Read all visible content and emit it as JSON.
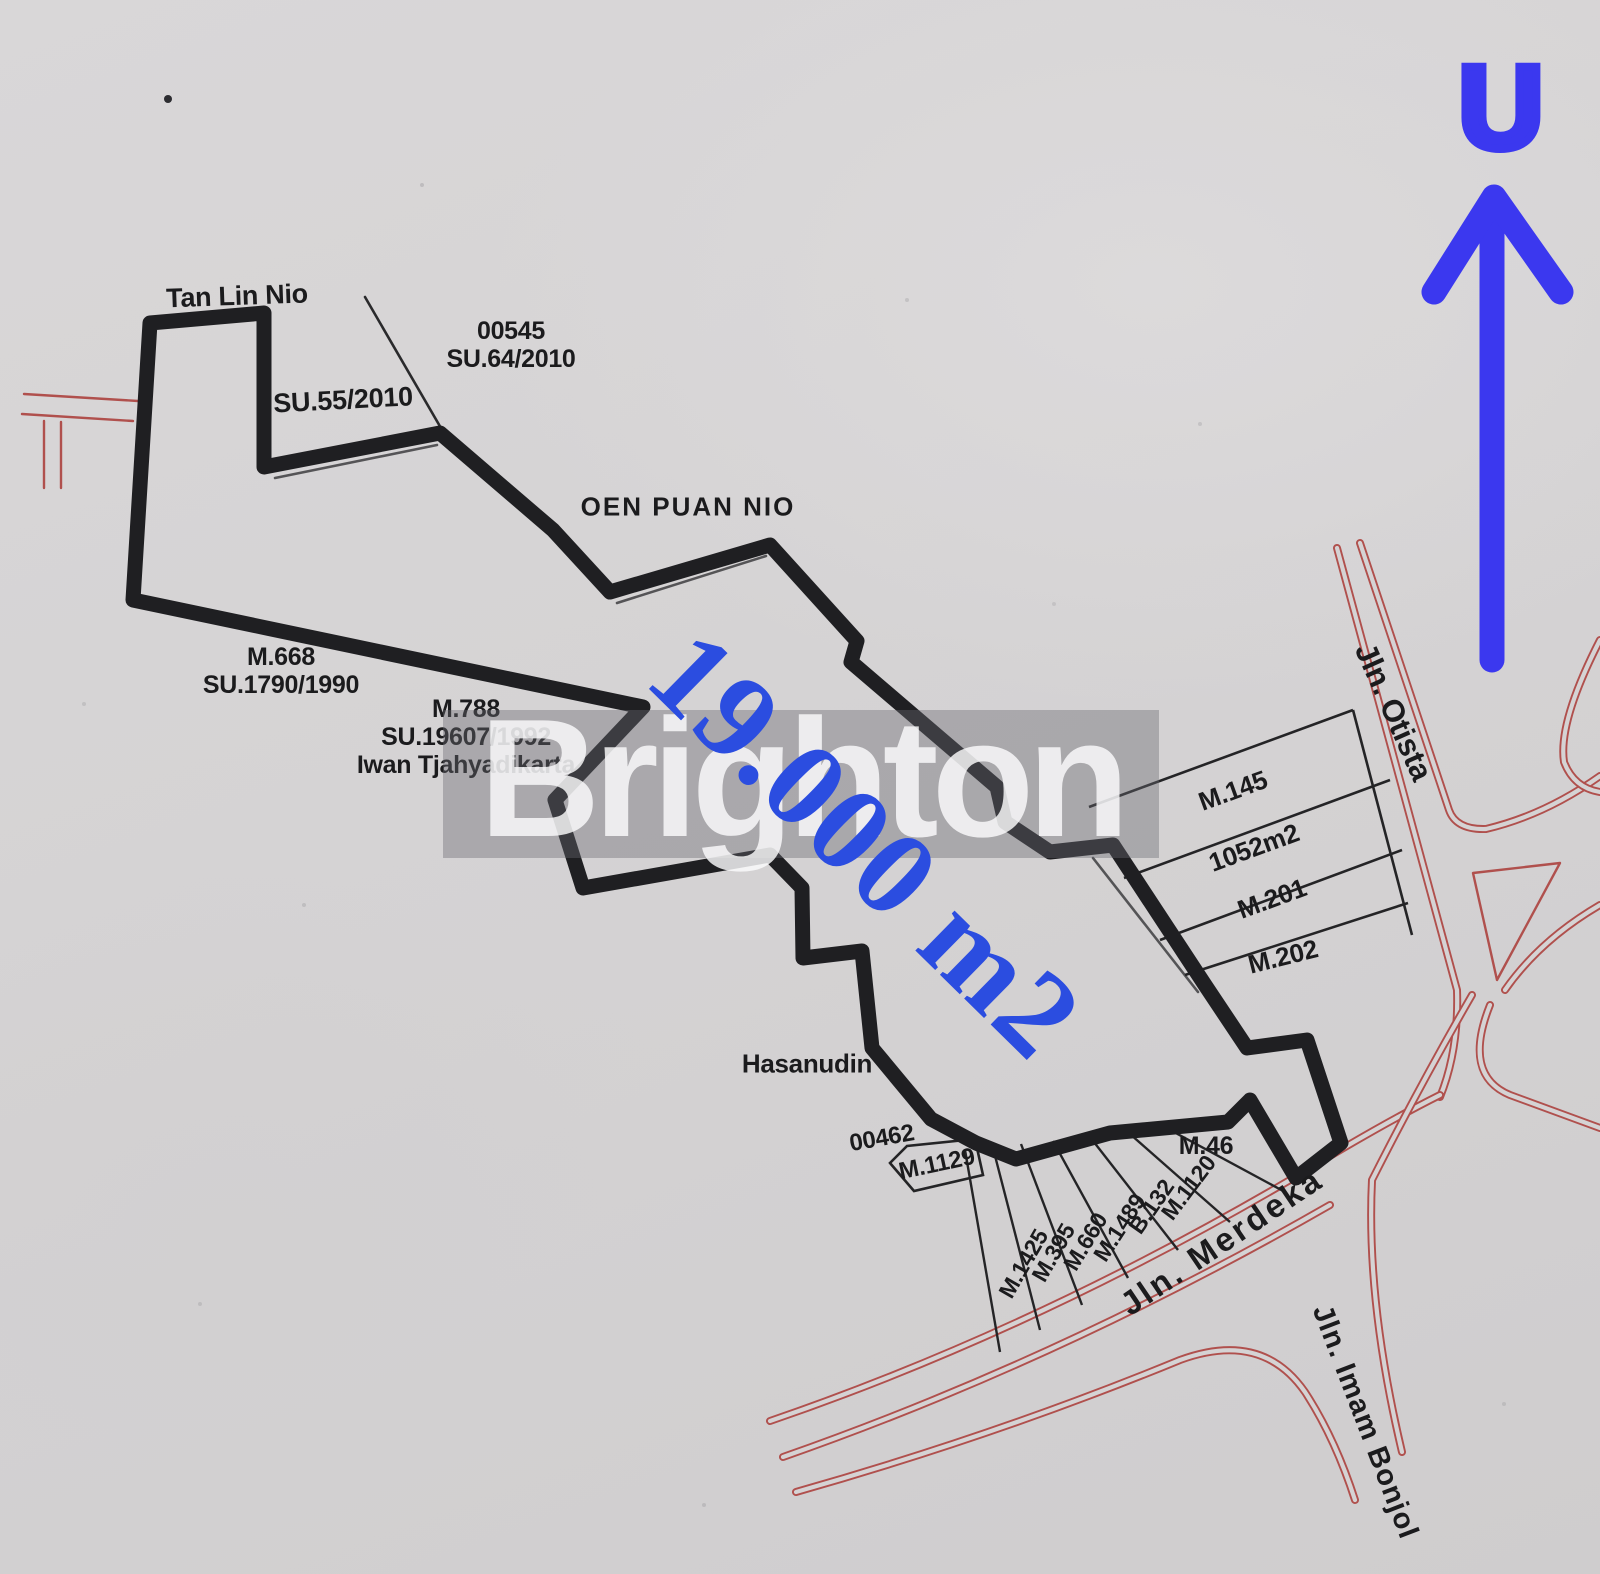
{
  "map_title_note": "cadastral sketch of land parcel",
  "north": {
    "letter": "U"
  },
  "watermark": {
    "text": "Brighton"
  },
  "area": {
    "value": "19.000 m2"
  },
  "colors": {
    "paper": "#d5d3d4",
    "ink": "#1f1f22",
    "road_red": "#b0504d",
    "north_blue": "#3b38ef",
    "area_blue": "#2b4de0"
  },
  "owners": {
    "tan_lin_nio": "Tan Lin Nio",
    "oen_puan_nio": "OEN PUAN NIO",
    "hasanudin": "Hasanudin"
  },
  "certificates": {
    "su55": "SU.55/2010",
    "p00545": {
      "line1": "00545",
      "line2": "SU.64/2010"
    },
    "m668": {
      "line1": "M.668",
      "line2": "SU.1790/1990"
    },
    "m788": {
      "line1": "M.788",
      "line2": "SU.19607/1992",
      "line3": "Iwan Tjahyadikarta"
    },
    "p00462": "00462",
    "m1129": "M.1129",
    "m46": "M.46"
  },
  "strips": [
    {
      "label": "M.145"
    },
    {
      "label": "1052m2"
    },
    {
      "label": "M.201"
    },
    {
      "label": "M.202"
    }
  ],
  "fan_parcels": [
    {
      "label": "M.1425"
    },
    {
      "label": "M.395"
    },
    {
      "label": "M.660"
    },
    {
      "label": "M.1489"
    },
    {
      "label": "B.132"
    },
    {
      "label": "M.1120"
    }
  ],
  "streets": [
    {
      "name": "Jln. Otista"
    },
    {
      "name": "Jln. Merdeka"
    },
    {
      "name": "Jln. Imam Bonjol"
    }
  ]
}
